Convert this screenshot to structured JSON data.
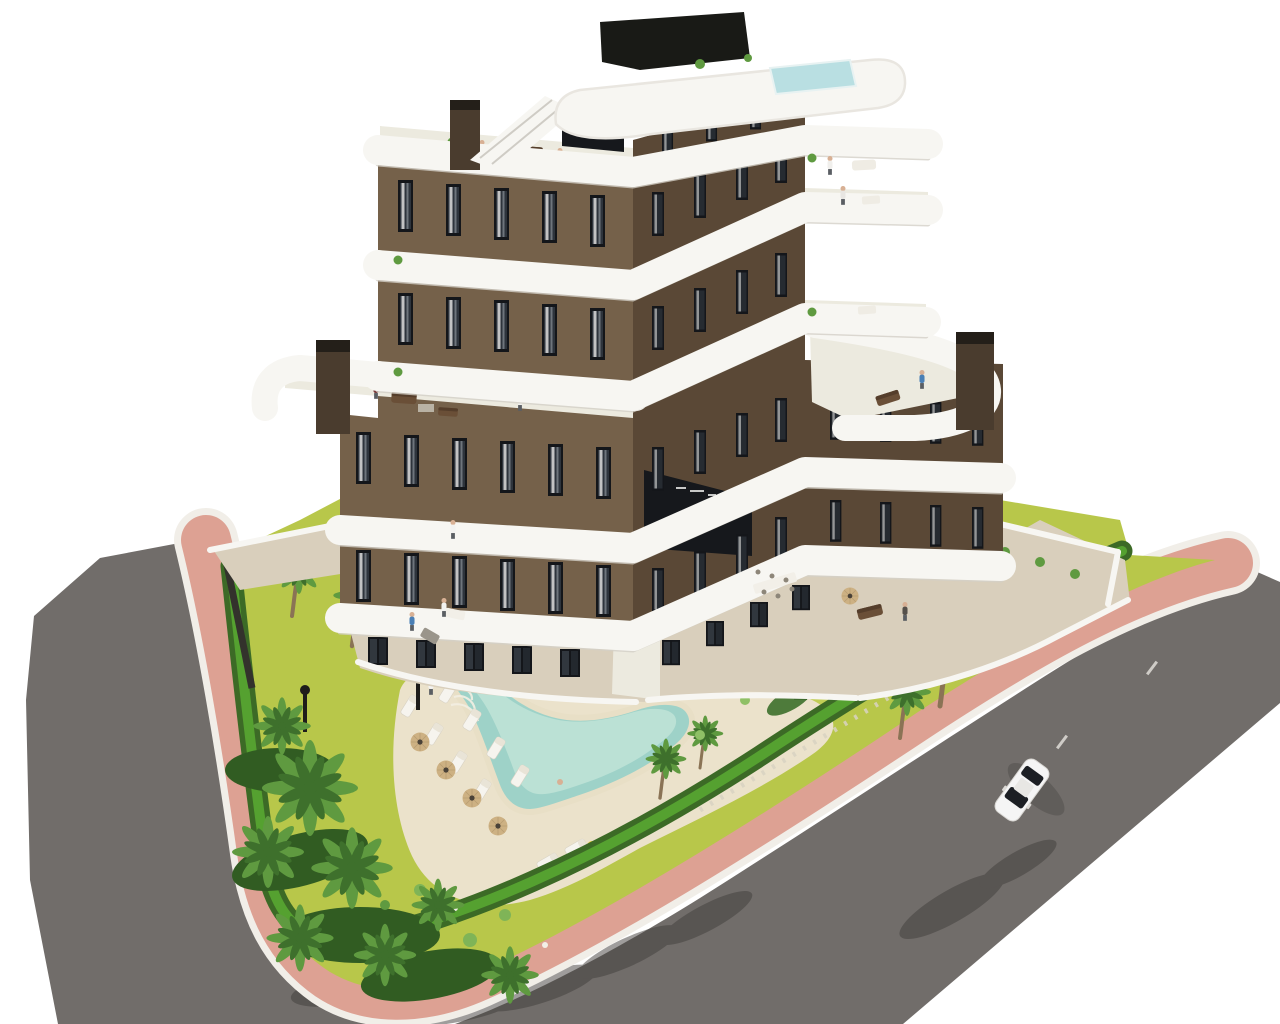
{
  "scene": {
    "type": "architectural-3d-render",
    "view": "aerial corner perspective",
    "visible_text": [],
    "building": {
      "levels_visible": 7,
      "wings": 2,
      "plan_shape": "chevron with inner corner entrance",
      "facade": "brown render with dark-framed floor-to-ceiling windows",
      "balconies": "continuous white curved slab bands with rounded ends",
      "rooftop": {
        "roof_terrace": true,
        "rooftop_pool": true,
        "stair_bulkhead": true,
        "external_stair": true
      },
      "chimneys": 3,
      "step_terraces": 2,
      "entrance": "dark glazed lobby at inner corner with illegible sign"
    },
    "garden": {
      "main_pool": "freeform lagoon pool with beige deck and roman steps",
      "central_island": "sand island with tall palm, rocks and shrubs",
      "sun_loungers": 10,
      "parasols": 4,
      "street_lamps": 2,
      "pool_float": "yellow ring",
      "palm_trees_approx": 20,
      "perimeter_hedge": true,
      "lawn": "bright yellow-green"
    },
    "roads": {
      "left_road": "dark asphalt street",
      "right_road": "dark asphalt street with faint dashed markings and palm shadows",
      "sidewalk": "salmon-pink walkway with white curbs wrapping the plot"
    },
    "vehicle": {
      "type": "car",
      "color": "white",
      "count": 1,
      "location": "right road"
    },
    "people_visible_approx": 13
  },
  "colors": {
    "background": "#ffffff",
    "asphalt": "#716d6a",
    "shadowDark": "#413e3b",
    "sidewalkPink": "#dda193",
    "curbWhite": "#f1eee8",
    "lawn": "#b8c74a",
    "lawnLight": "#cdd766",
    "hedgeDark": "#3c6a26",
    "hedgeBright": "#55a130",
    "gravel": "#d8d2c2",
    "palmDark": "#3e702c",
    "palmMid": "#5f9a40",
    "palmLight": "#7fb457",
    "trunk": "#8a7355",
    "sand": "#e7ddc2",
    "soil": "#55523d",
    "deck": "#ebe2cb",
    "poolWater": "#9ed2c8",
    "poolShallow": "#c4e6da",
    "poolRim": "#e8dfc6",
    "slabWhite": "#f7f6f2",
    "slabShadow": "#d3cfc7",
    "facadeLit": "#75614a",
    "facadeShade": "#5a4836",
    "glassDark": "#16181c",
    "windowFrame": "#14161a",
    "windowGlass": "#2e343c",
    "curtain": "#dcdcda",
    "paving": "#d9cfbc",
    "terraceFloor": "#eceadf",
    "chimney": "#4a3c2e",
    "fenceDark": "#33322c",
    "rockWhite": "#f2efe7",
    "carBody": "#f5f5f5",
    "carGlass": "#1c1f24",
    "lampBlack": "#1e1d1b",
    "parasolTan": "#cdb183",
    "floatYellow": "#e8c832",
    "skin": "#d8b094",
    "shirtBlue": "#4a7fb5",
    "poolTopBlue": "#b9dfe2"
  }
}
